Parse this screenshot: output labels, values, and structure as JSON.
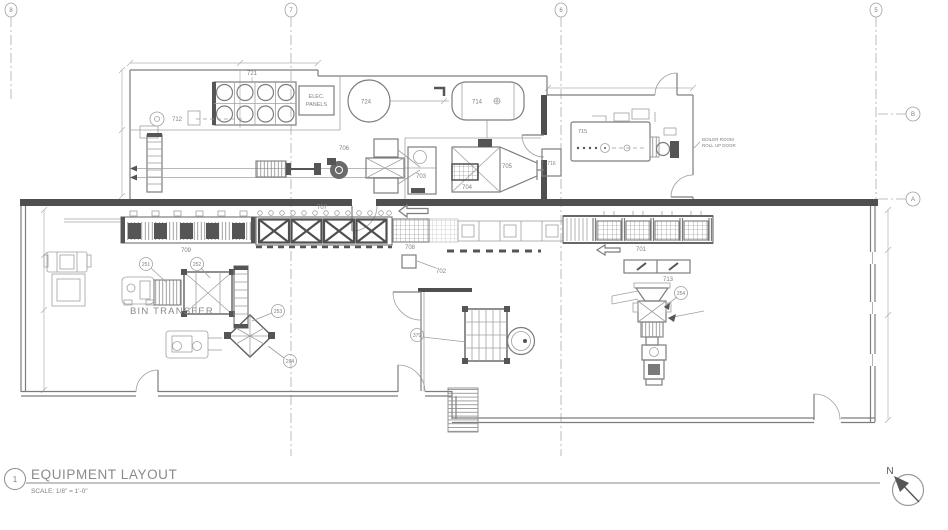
{
  "sheet": {
    "detail_number": "1",
    "title": "EQUIPMENT LAYOUT",
    "scale_note": "SCALE: 1/8\" = 1'-0\"",
    "north_label": "N"
  },
  "grid": {
    "col_a": "8",
    "col_b": "7",
    "col_c": "6",
    "col_d": "5",
    "row_top": "B",
    "row_bottom": "A"
  },
  "notes": {
    "elec_panels_1": "ELEC.",
    "elec_panels_2": "PANELS",
    "boiler_room_1": "BOILER ROOM",
    "boiler_room_2": "ROLL UP DOOR",
    "bin_transfer": "BIN TRANSFER"
  },
  "eq": {
    "e701": "701",
    "e702": "702",
    "e703": "703",
    "e704": "704",
    "e705": "705",
    "e706": "706",
    "e707": "707",
    "e708": "708",
    "e709": "709",
    "e712": "712",
    "e713": "713",
    "e714": "714",
    "e715": "715",
    "e716": "716",
    "e721": "721",
    "e724": "724"
  },
  "tags": {
    "t251": "251",
    "t252": "252",
    "t253": "253",
    "t264": "264",
    "t379": "379",
    "t254": "254"
  },
  "colors": {
    "line": "#8a8a8a",
    "wall": "#4f4f4f",
    "text": "#808080",
    "dark": "#555555"
  }
}
